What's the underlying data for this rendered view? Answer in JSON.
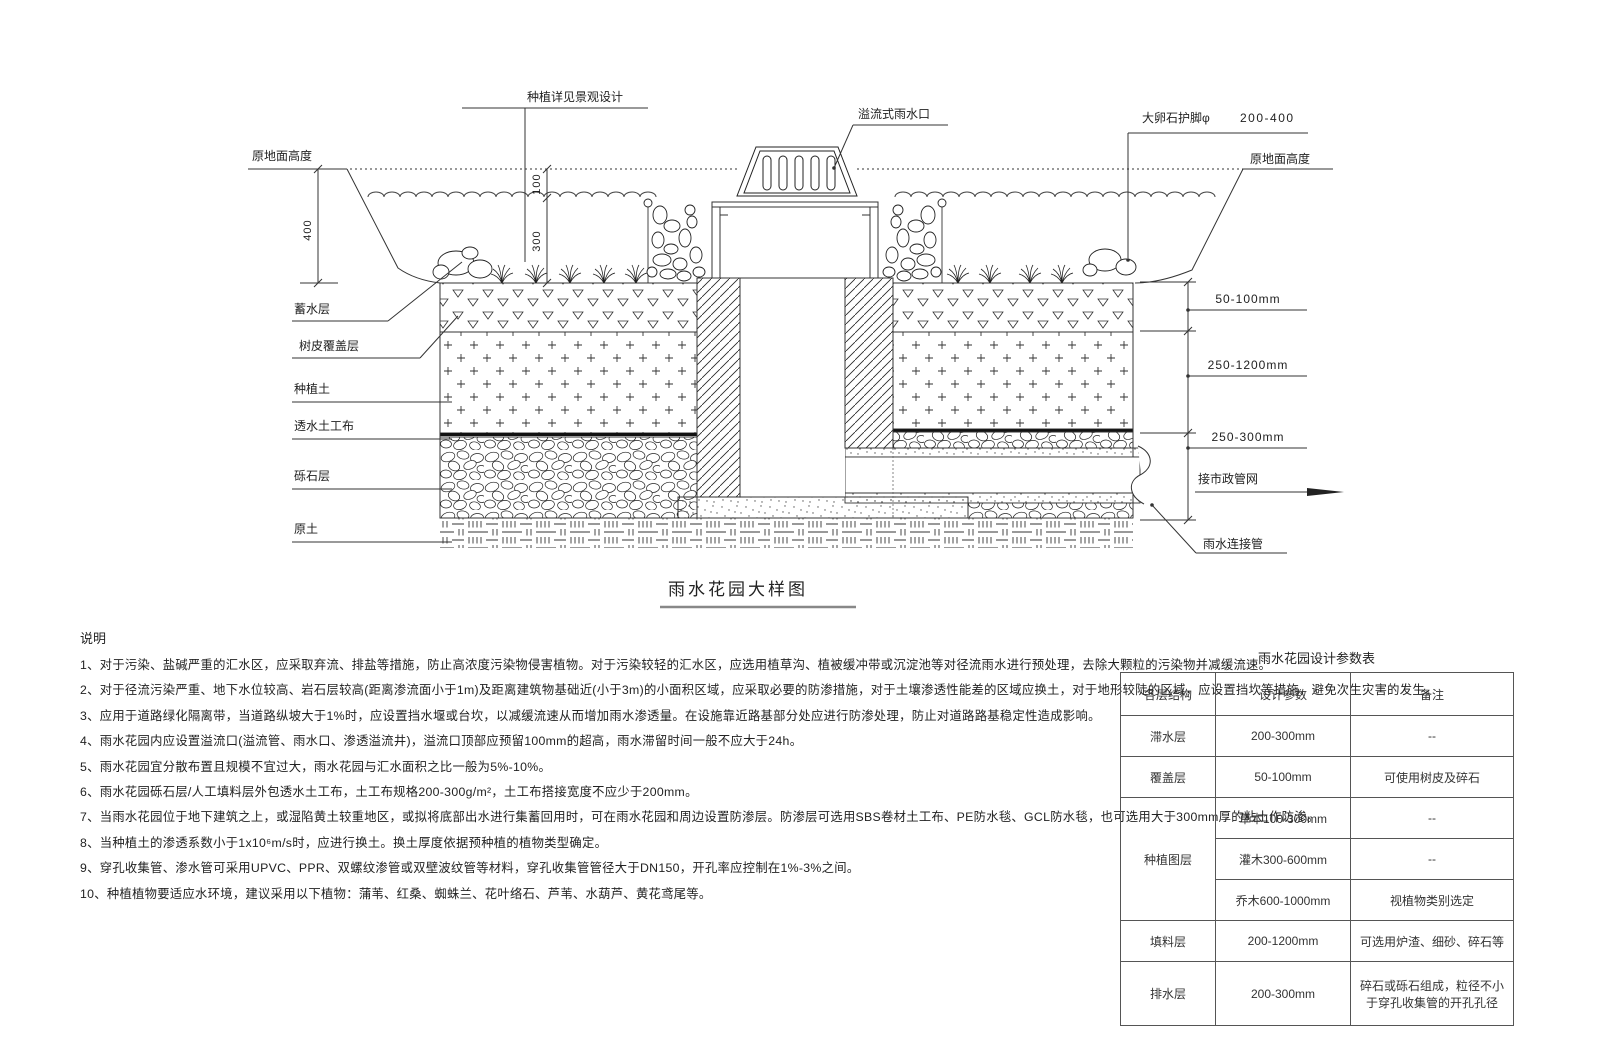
{
  "drawing": {
    "title": "雨水花园大样图",
    "top_labels": {
      "planting_note": "种植详见景观设计",
      "overflow_inlet": "溢流式雨水口",
      "boulder_label": "大卵石护脚φ",
      "boulder_size": "200-400",
      "ground_left": "原地面高度",
      "ground_right": "原地面高度"
    },
    "layer_labels": [
      "蓄水层",
      "树皮覆盖层",
      "种植土",
      "透水土工布",
      "砾石层",
      "原土"
    ],
    "dims": {
      "total_depth": "400",
      "freeboard": "100",
      "storage": "300",
      "mulch_range": "50-100mm",
      "soil_range": "250-1200mm",
      "drain_range": "250-300mm"
    },
    "pipe_labels": {
      "municipal": "接市政管网",
      "connector": "雨水连接管"
    }
  },
  "notes": {
    "heading": "说明",
    "items": [
      "1、对于污染、盐碱严重的汇水区，应采取弃流、排盐等措施，防止高浓度污染物侵害植物。对于污染较轻的汇水区，应选用植草沟、植被缓冲带或沉淀池等对径流雨水进行预处理，去除大颗粒的污染物并减缓流速。",
      "2、对于径流污染严重、地下水位较高、岩石层较高(距离渗流面小于1m)及距离建筑物基础近(小于3m)的小面积区域，应采取必要的防渗措施，对于土壤渗透性能差的区域应换土，对于地形较陡的区域，应设置挡坎等措施，避免次生灾害的发生。",
      "3、应用于道路绿化隔离带，当道路纵坡大于1%时，应设置挡水堰或台坎，以减缓流速从而增加雨水渗透量。在设施靠近路基部分处应进行防渗处理，防止对道路路基稳定性造成影响。",
      "4、雨水花园内应设置溢流口(溢流管、雨水口、渗透溢流井)，溢流口顶部应预留100mm的超高，雨水滞留时间一般不应大于24h。",
      "5、雨水花园宜分散布置且规模不宜过大，雨水花园与汇水面积之比一般为5%-10%。",
      "6、雨水花园砾石层/人工填料层外包透水土工布，土工布规格200-300g/m²，土工布搭接宽度不应少于200mm。",
      "7、当雨水花园位于地下建筑之上，或湿陷黄土较重地区，或拟将底部出水进行集蓄回用时，可在雨水花园和周边设置防渗层。防渗层可选用SBS卷材土工布、PE防水毯、GCL防水毯，也可选用大于300mm厚的粘土作防渗。",
      "8、当种植土的渗透系数小于1x10⁶m/s时，应进行换土。换土厚度依据预种植的植物类型确定。",
      "9、穿孔收集管、渗水管可采用UPVC、PPR、双螺纹渗管或双壁波纹管等材料，穿孔收集管管径大于DN150，开孔率应控制在1%-3%之间。",
      "10、种植植物要适应水环境，建议采用以下植物：蒲苇、红桑、蜘蛛兰、花叶络石、芦苇、水葫芦、黄花鸢尾等。"
    ]
  },
  "table": {
    "title": "雨水花园设计参数表",
    "headers": [
      "各层结构",
      "设计参数",
      "备注"
    ],
    "rows": [
      [
        "滞水层",
        "200-300mm",
        "--"
      ],
      [
        "覆盖层",
        "50-100mm",
        "可使用树皮及碎石"
      ],
      [
        "种植图层",
        "草本100-300mm",
        "--"
      ],
      [
        "",
        "灌木300-600mm",
        "--"
      ],
      [
        "",
        "乔木600-1000mm",
        "视植物类别选定"
      ],
      [
        "填料层",
        "200-1200mm",
        "可选用炉渣、细砂、碎石等"
      ],
      [
        "排水层",
        "200-300mm",
        "碎石或砾石组成，粒径不小于穿孔收集管的开孔孔径"
      ]
    ]
  }
}
